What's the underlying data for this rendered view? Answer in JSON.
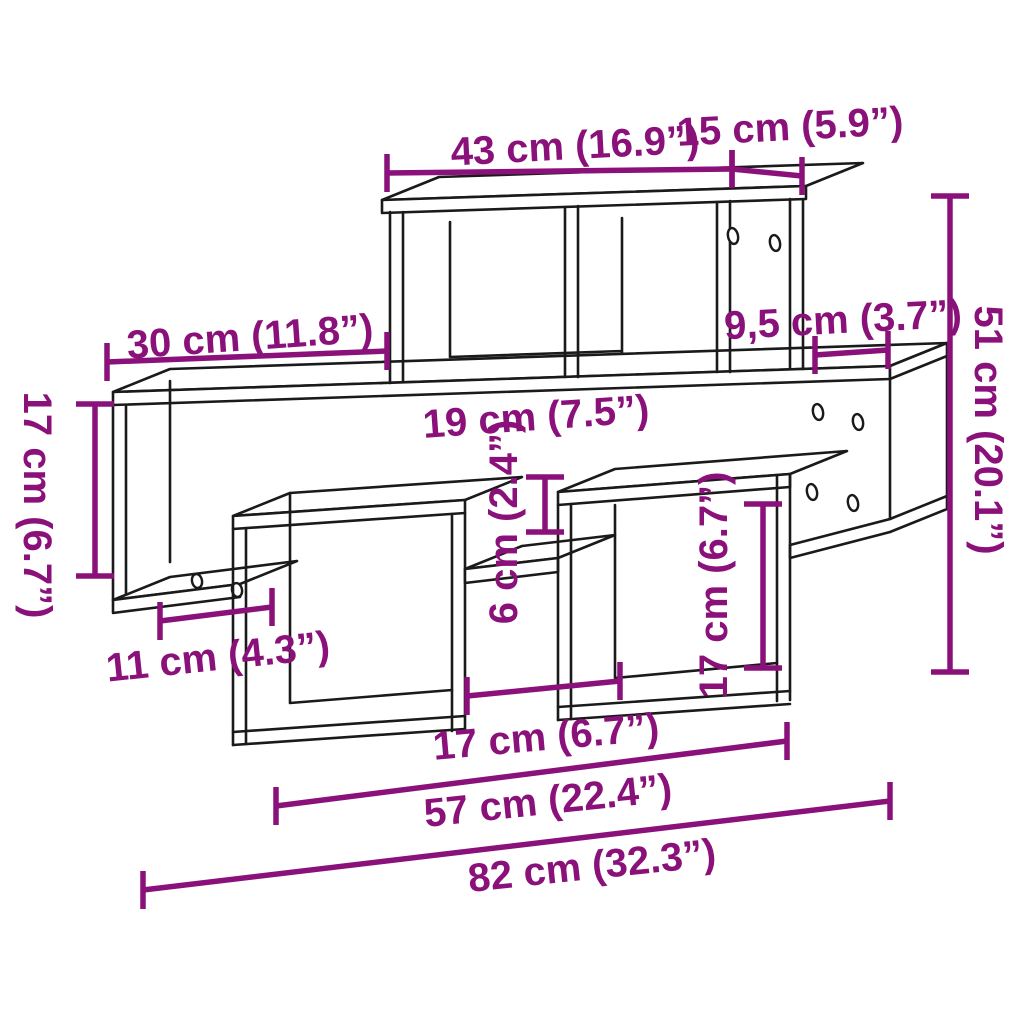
{
  "title": "Wall shelf dimension diagram",
  "colors": {
    "dimension_accent": "#8B117A",
    "outline": "#1A1A1A",
    "background": "#FFFFFF"
  },
  "stroke": {
    "dimension_width": 5.5,
    "tick_length": 38
  },
  "measurements_cm": [
    "43",
    "15",
    "30",
    "9,5",
    "19",
    "6",
    "17",
    "51",
    "11",
    "17",
    "17",
    "57",
    "82"
  ],
  "annotations": [
    {
      "id": "dim-43cm",
      "label": "43 cm (16.9”)",
      "text": {
        "x": 575,
        "y": 146,
        "rotation": -3
      },
      "line": {
        "x1": 387,
        "y1": 173,
        "x2": 732,
        "y2": 169
      },
      "ticks": "vertical"
    },
    {
      "id": "dim-15cm",
      "label": "15 cm (5.9”)",
      "text": {
        "x": 790,
        "y": 127,
        "rotation": -3
      },
      "line": {
        "x1": 732,
        "y1": 169,
        "x2": 802,
        "y2": 176
      },
      "ticks": "vertical"
    },
    {
      "id": "dim-30cm",
      "label": "30 cm (11.8”)",
      "text": {
        "x": 250,
        "y": 337,
        "rotation": -4
      },
      "line": {
        "x1": 107,
        "y1": 362,
        "x2": 387,
        "y2": 351
      },
      "ticks": "vertical"
    },
    {
      "id": "dim-9-5cm",
      "label": "9,5 cm (3.7”)",
      "text": {
        "x": 843,
        "y": 320,
        "rotation": -3
      },
      "line": {
        "x1": 815,
        "y1": 355,
        "x2": 888,
        "y2": 350
      },
      "ticks": "vertical"
    },
    {
      "id": "label-19cm",
      "label": "19 cm (7.5”)",
      "text": {
        "x": 536,
        "y": 417,
        "rotation": -4
      },
      "line": null,
      "ticks": "none"
    },
    {
      "id": "dim-6cm",
      "label": "6 cm (2.4”)",
      "text": {
        "x": 504,
        "y": 522,
        "rotation": -90
      },
      "line": {
        "x1": 545,
        "y1": 477,
        "x2": 545,
        "y2": 532
      },
      "ticks": "horizontal"
    },
    {
      "id": "dim-17cm-left",
      "label": "17 cm (6.7”)",
      "text": {
        "x": 37,
        "y": 505,
        "rotation": 90
      },
      "line": {
        "x1": 95,
        "y1": 404,
        "x2": 95,
        "y2": 576
      },
      "ticks": "horizontal"
    },
    {
      "id": "dim-17cm-box",
      "label": "17 cm (6.7”)",
      "text": {
        "x": 714,
        "y": 585,
        "rotation": -90
      },
      "line": {
        "x1": 763,
        "y1": 504,
        "x2": 763,
        "y2": 668
      },
      "ticks": "horizontal"
    },
    {
      "id": "dim-51cm",
      "label": "51 cm (20.1”)",
      "text": {
        "x": 988,
        "y": 430,
        "rotation": 90
      },
      "line": {
        "x1": 950,
        "y1": 196,
        "x2": 950,
        "y2": 672
      },
      "ticks": "horizontal"
    },
    {
      "id": "dim-11cm",
      "label": "11 cm (4.3”)",
      "text": {
        "x": 218,
        "y": 657,
        "rotation": -6
      },
      "line": {
        "x1": 160,
        "y1": 621,
        "x2": 272,
        "y2": 607
      },
      "ticks": "vertical"
    },
    {
      "id": "dim-17cm-bottom",
      "label": "17 cm (6.7”)",
      "text": {
        "x": 546,
        "y": 737,
        "rotation": -5
      },
      "line": {
        "x1": 467,
        "y1": 696,
        "x2": 620,
        "y2": 681
      },
      "ticks": "vertical"
    },
    {
      "id": "dim-57cm",
      "label": "57 cm (22.4”)",
      "text": {
        "x": 548,
        "y": 801,
        "rotation": -6
      },
      "line": {
        "x1": 276,
        "y1": 806,
        "x2": 787,
        "y2": 741
      },
      "ticks": "vertical"
    },
    {
      "id": "dim-82cm",
      "label": "82 cm (32.3”)",
      "text": {
        "x": 592,
        "y": 866,
        "rotation": -6
      },
      "line": {
        "x1": 143,
        "y1": 890,
        "x2": 890,
        "y2": 801
      },
      "ticks": "vertical"
    }
  ]
}
